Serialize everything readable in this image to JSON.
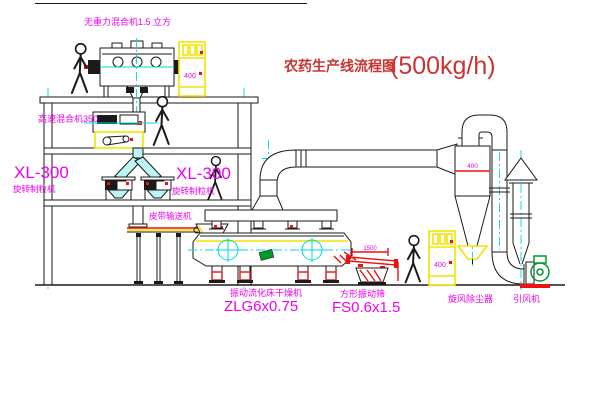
{
  "title": {
    "cn": "农药生产线流程图",
    "capacity": "(500kg/h)"
  },
  "colors": {
    "bg": "#ffffff",
    "line": "#1a1a1a",
    "magenta": "#ee00ee",
    "red": "#ee1111",
    "titlered": "#cc3333",
    "yellow": "#f2e400",
    "cyan": "#00d8d8",
    "cyanfill": "#bdf4f4",
    "green": "#009a2a"
  },
  "equipment": {
    "gravity_mixer": {
      "label": "无重力混合机1.5 立方"
    },
    "high_speed_mixer": {
      "label": "高速混合机350"
    },
    "granulator_left": {
      "model": "XL-300",
      "name": "旋转制粒机"
    },
    "granulator_right": {
      "model": "XL-300",
      "name": "旋转制粒机"
    },
    "belt_conveyor": {
      "label": "皮带输送机"
    },
    "dryer": {
      "name": "振动流化床干燥机",
      "model": "ZLG6x0.75"
    },
    "screen": {
      "name": "方形振动筛",
      "model": "FS0.6x1.5",
      "dim": "1500"
    },
    "cyclone": {
      "label": "旋风除尘器",
      "size": "400"
    },
    "fan": {
      "label": "引风机"
    },
    "control_cabinet": {
      "label": "400"
    }
  }
}
